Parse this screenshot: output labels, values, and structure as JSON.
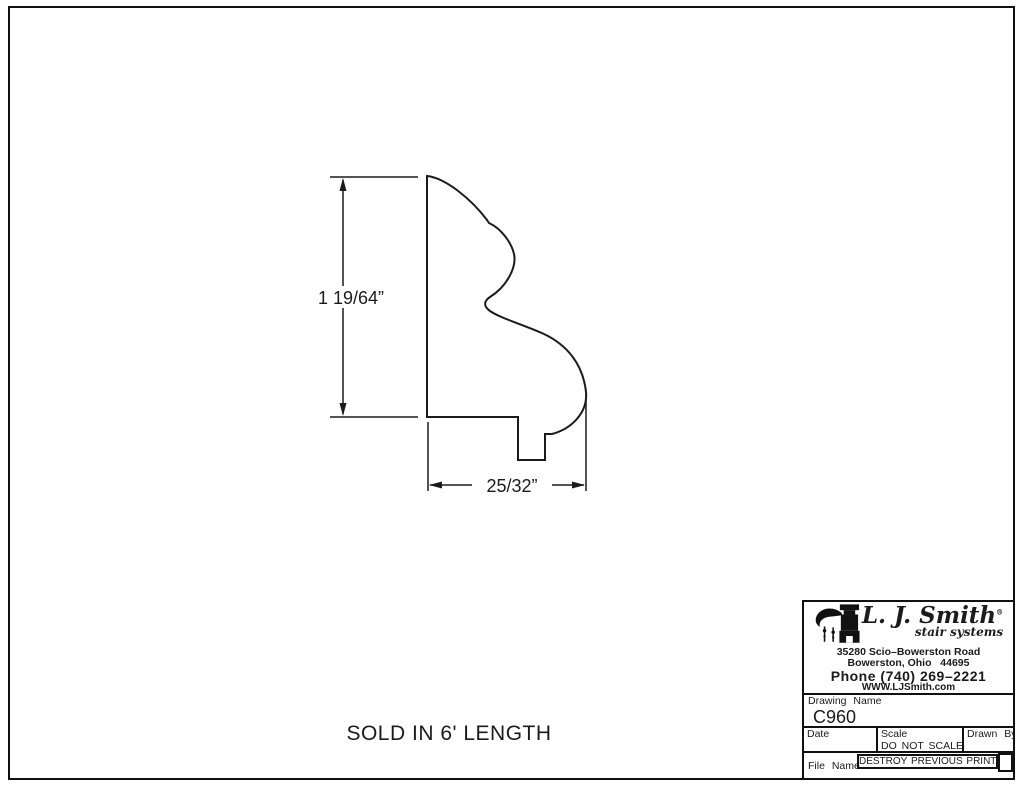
{
  "sheet": {
    "sold_note": "SOLD IN 6' LENGTH"
  },
  "dimensions": {
    "height": "1 19/64”",
    "width": "25/32”"
  },
  "title_block": {
    "logo": {
      "name": "L. J. Smith",
      "reg": "®",
      "tagline": "stair systems"
    },
    "address1": "35280 Scio–Bowerston Road",
    "address2": "Bowerston, Ohio   44695",
    "phone": "Phone (740) 269–2221",
    "website": "WWW.LJSmith.com",
    "drawing_name_label": "Drawing Name",
    "drawing_number": "C960",
    "date_label": "Date",
    "scale_label": "Scale",
    "scale_value": "DO NOT SCALE",
    "drawn_by_label": "Drawn By",
    "file_name_label": "File Name",
    "destroy_note": "DESTROY PREVIOUS PRINTS"
  },
  "colors": {
    "ink": "#1b1b1b",
    "paper": "#ffffff"
  }
}
